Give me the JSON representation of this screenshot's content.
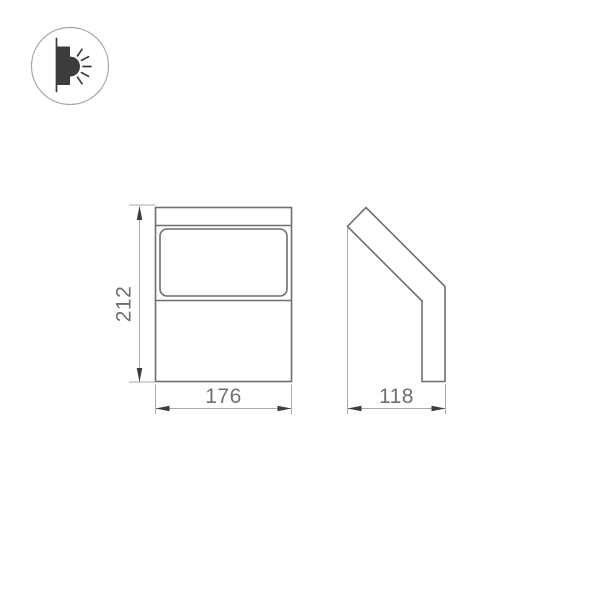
{
  "icon": {
    "name": "wall-light-emitting-icon",
    "description": "circled pictogram of a wall-mounted luminaire emitting light rays"
  },
  "drawing": {
    "type": "technical dimension drawing",
    "views": {
      "front": {
        "name": "front-view",
        "height_label": "212",
        "width_label": "176"
      },
      "side": {
        "name": "side-view",
        "depth_label": "118"
      }
    }
  },
  "colors": {
    "background": "#ffffff",
    "outline": "#6f6f6f",
    "thin_line": "#ababab",
    "arrow": "#3d3d3d",
    "text": "#6f6f6f",
    "icon_fill": "#3c3c3c",
    "icon_circle_border": "#a6a6a6"
  }
}
